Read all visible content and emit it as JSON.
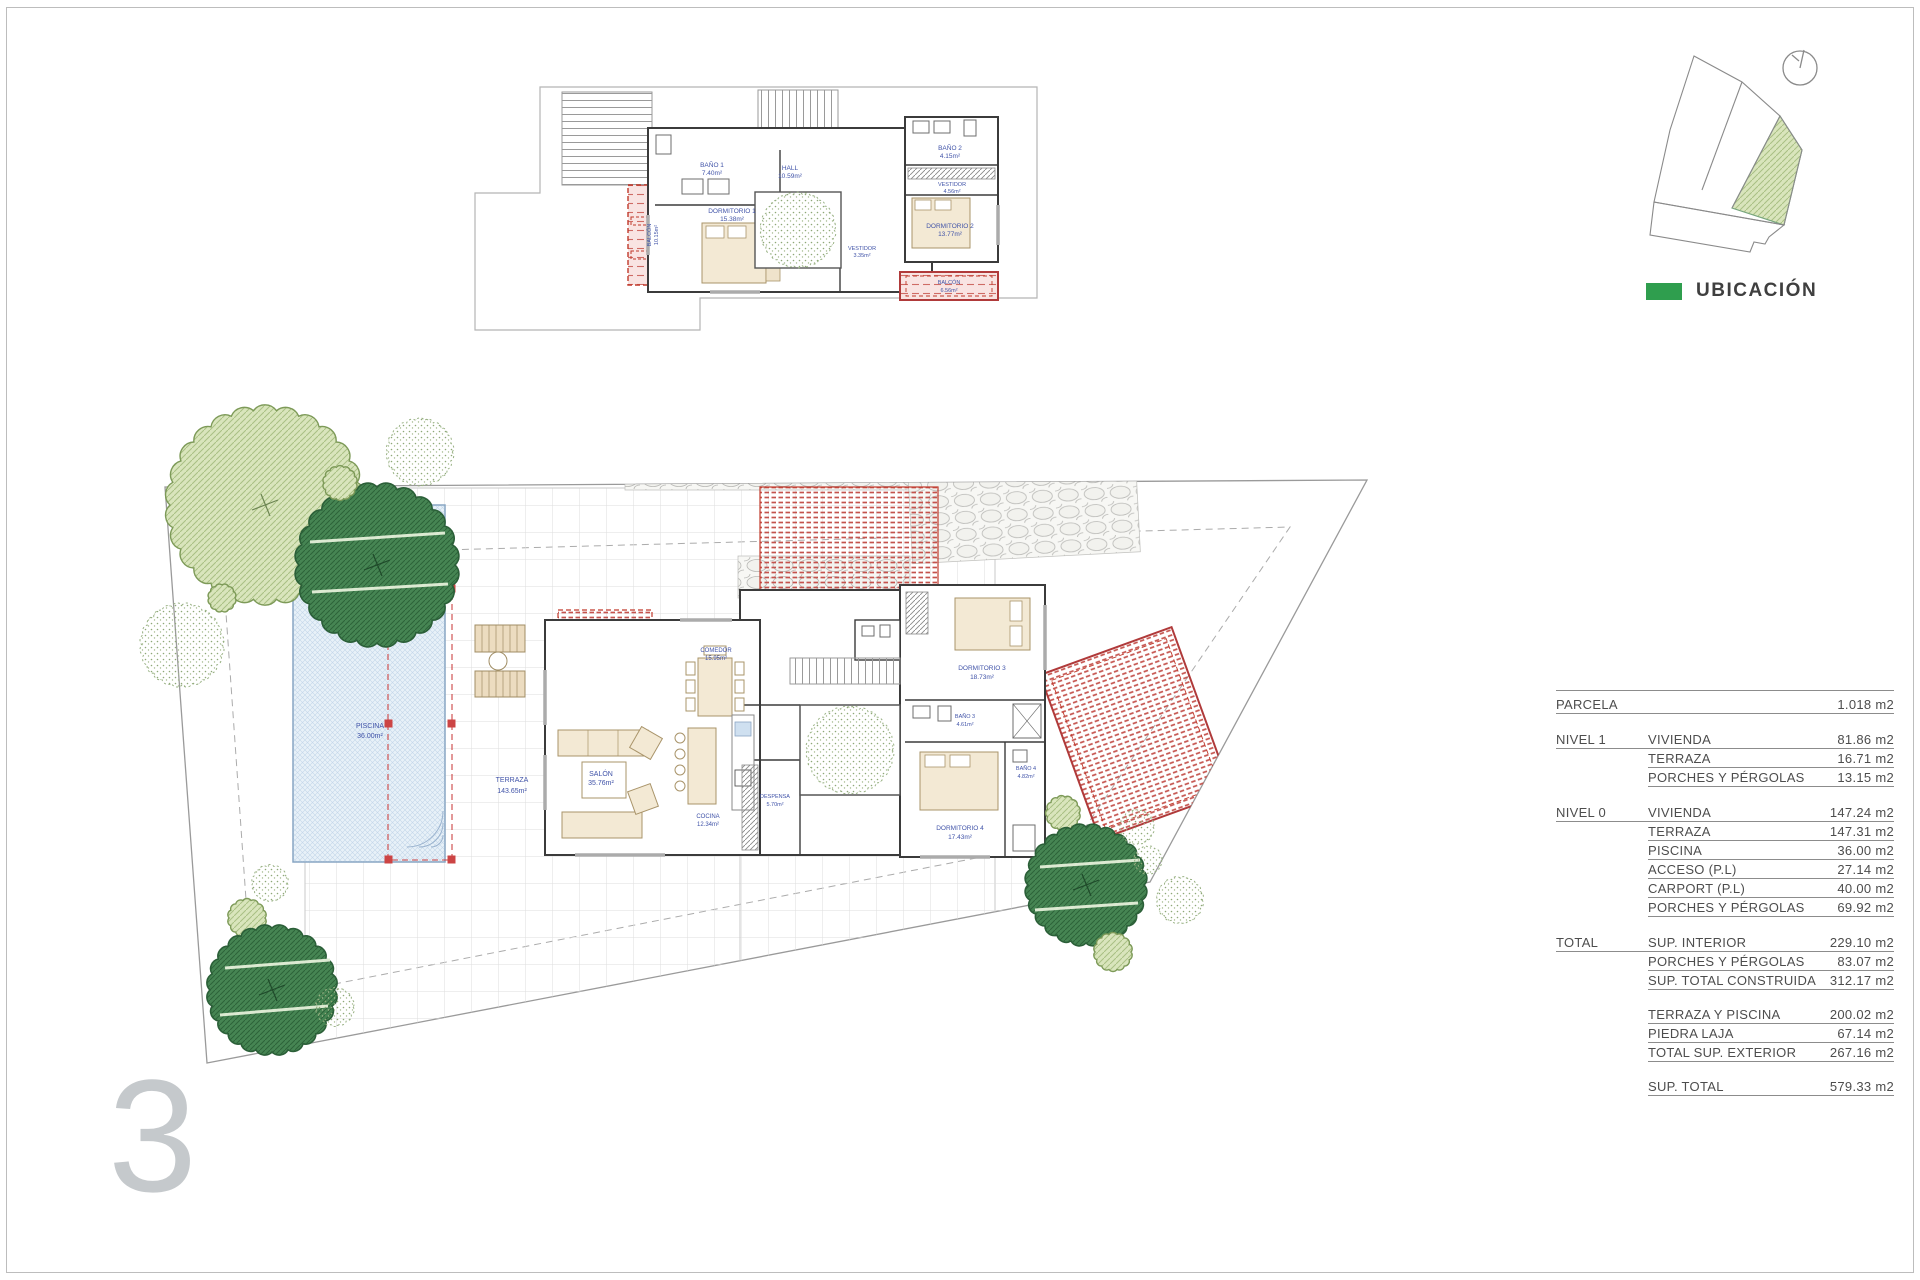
{
  "page": {
    "sheet_number": "3"
  },
  "location": {
    "legend_label": "UBICACIÓN",
    "legend_color": "#2f9e4e"
  },
  "nivel1": {
    "bano1": {
      "name": "BAÑO 1",
      "area": "7.40m²"
    },
    "dormitorio1": {
      "name": "DORMITORIO 1",
      "area": "15.38m²"
    },
    "vestidor1": {
      "name": "VESTIDOR",
      "area": "3.35m²"
    },
    "hall": {
      "name": "HALL",
      "area": "10.59m²"
    },
    "bano2": {
      "name": "BAÑO 2",
      "area": "4.15m²"
    },
    "vestidor2": {
      "name": "VESTIDOR",
      "area": "4.56m²"
    },
    "dormitorio2": {
      "name": "DORMITORIO 2",
      "area": "13.77m²"
    },
    "balcon1": {
      "name": "BALCÓN",
      "area": "10.15m²"
    },
    "balcon2": {
      "name": "BALCÓN",
      "area": "6.56m²"
    }
  },
  "nivel0": {
    "piscina": {
      "name": "PISCINA",
      "area": "36.00m²"
    },
    "terraza": {
      "name": "TERRAZA",
      "area": "143.65m²"
    },
    "salon": {
      "name": "SALÓN",
      "area": "35.76m²"
    },
    "comedor": {
      "name": "COMEDOR",
      "area": "15.95m²"
    },
    "cocina": {
      "name": "COCINA",
      "area": "12.34m²"
    },
    "despensa": {
      "name": "DESPENSA",
      "area": "5.70m²"
    },
    "dormitorio3": {
      "name": "DORMITORIO 3",
      "area": "18.73m²"
    },
    "bano3": {
      "name": "BAÑO 3",
      "area": "4.61m²"
    },
    "dormitorio4": {
      "name": "DORMITORIO 4",
      "area": "17.43m²"
    },
    "bano4": {
      "name": "BAÑO 4",
      "area": "4.82m²"
    }
  },
  "areas_table": {
    "rows": [
      {
        "g": "PARCELA",
        "i": "",
        "v": "1.018 m2",
        "r": "full"
      },
      {
        "r": "gap"
      },
      {
        "g": "NIVEL 1",
        "i": "VIVIENDA",
        "v": "81.86 m2",
        "r": "full"
      },
      {
        "g": "",
        "i": "TERRAZA",
        "v": "16.71 m2",
        "r": "item"
      },
      {
        "g": "",
        "i": "PORCHES Y PÉRGOLAS",
        "v": "13.15 m2",
        "r": "item"
      },
      {
        "r": "gap"
      },
      {
        "g": "NIVEL 0",
        "i": "VIVIENDA",
        "v": "147.24 m2",
        "r": "full"
      },
      {
        "g": "",
        "i": "TERRAZA",
        "v": "147.31 m2",
        "r": "item"
      },
      {
        "g": "",
        "i": "PISCINA",
        "v": "36.00 m2",
        "r": "item"
      },
      {
        "g": "",
        "i": "ACCESO (P.L)",
        "v": "27.14 m2",
        "r": "item"
      },
      {
        "g": "",
        "i": "CARPORT (P.L)",
        "v": "40.00 m2",
        "r": "item"
      },
      {
        "g": "",
        "i": "PORCHES Y PÉRGOLAS",
        "v": "69.92 m2",
        "r": "item"
      },
      {
        "r": "gap"
      },
      {
        "g": "TOTAL",
        "i": "SUP. INTERIOR",
        "v": "229.10 m2",
        "r": "full"
      },
      {
        "g": "",
        "i": "PORCHES Y PÉRGOLAS",
        "v": "83.07 m2",
        "r": "item"
      },
      {
        "g": "",
        "i": "SUP. TOTAL CONSTRUIDA",
        "v": "312.17 m2",
        "r": "item"
      },
      {
        "r": "gap"
      },
      {
        "g": "",
        "i": "TERRAZA Y PISCINA",
        "v": "200.02 m2",
        "r": "item"
      },
      {
        "g": "",
        "i": "PIEDRA LAJA",
        "v": "67.14 m2",
        "r": "item"
      },
      {
        "g": "",
        "i": "TOTAL SUP. EXTERIOR",
        "v": "267.16 m2",
        "r": "item"
      },
      {
        "r": "gap"
      },
      {
        "g": "",
        "i": "SUP. TOTAL",
        "v": "579.33 m2",
        "r": "item"
      }
    ]
  }
}
